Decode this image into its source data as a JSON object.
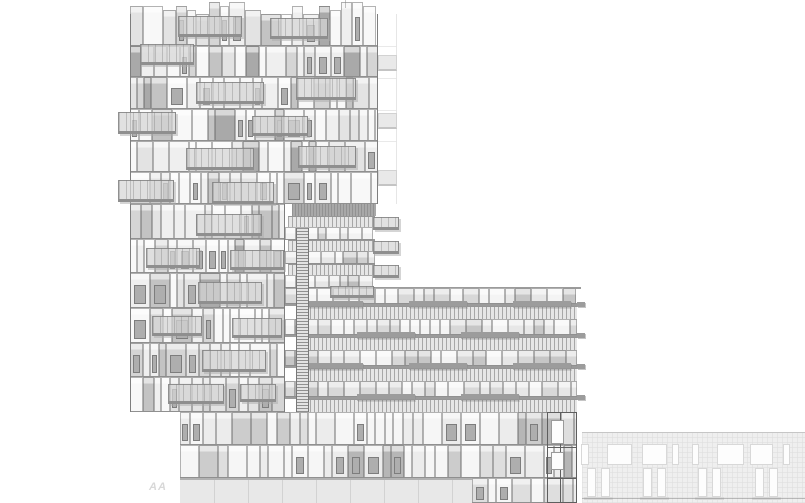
{
  "drawing": {
    "title": "building-elevation-drawing",
    "canvas": {
      "w": 805,
      "h": 503,
      "bg": "#ffffff"
    },
    "seed": 11,
    "line_color": "#8a8a8a",
    "panels": {
      "tower": {
        "widths": [
          7,
          9,
          11,
          13,
          16,
          20
        ],
        "winProb": 0.3,
        "shades": [
          [
            "#f8f8f8",
            26
          ],
          [
            "#efefef",
            22
          ],
          [
            "#e3e3e3",
            20
          ],
          [
            "#d5d5d5",
            14
          ],
          [
            "#c3c3c3",
            11
          ],
          [
            "#a9a9a9",
            7
          ]
        ]
      },
      "wing": {
        "widths": [
          8,
          11,
          14
        ],
        "winProb": 0.15,
        "shades": [
          [
            "#f3f3f3",
            35
          ],
          [
            "#e6e6e6",
            35
          ],
          [
            "#cfcfcf",
            20
          ],
          [
            "#bdbdbd",
            10
          ]
        ]
      },
      "midrise": {
        "widths": [
          10,
          13,
          16
        ],
        "winProb": 0.12,
        "shades": [
          [
            "#f4f4f4",
            30
          ],
          [
            "#e7e7e7",
            28
          ],
          [
            "#d8d8d8",
            24
          ],
          [
            "#c6c6c6",
            18
          ]
        ]
      },
      "podium": {
        "widths": [
          8,
          10,
          13,
          16,
          19
        ],
        "winProb": 0.26,
        "shades": [
          [
            "#f6f6f6",
            38
          ],
          [
            "#ececec",
            28
          ],
          [
            "#dedede",
            16
          ],
          [
            "#cccccc",
            12
          ],
          [
            "#b6b6b6",
            6
          ]
        ]
      }
    },
    "tower": {
      "upper": {
        "x": 130,
        "y": 14,
        "w": 248,
        "floors": 6,
        "floor_h": 31.67
      },
      "lower": {
        "x": 130,
        "y": 204,
        "w": 155,
        "floors": 6,
        "floor_h": 34.67
      },
      "edges": [
        {
          "x": 130,
          "y": 14,
          "h": 398
        },
        {
          "x": 377,
          "y": 14,
          "h": 190
        },
        {
          "x": 284,
          "y": 204,
          "h": 208
        }
      ],
      "roof_tick": {
        "x": 345,
        "y": 0,
        "h": 8
      }
    },
    "strip": {
      "x": 378,
      "w": 19,
      "y": 14,
      "h": 190,
      "balcony_ys": [
        55,
        113,
        170
      ],
      "balcony_h": 16,
      "line_ys": [
        46,
        78,
        110,
        141,
        173
      ]
    },
    "balconies": [
      {
        "x": 178,
        "y": 16,
        "w": 64,
        "h": 21
      },
      {
        "x": 270,
        "y": 18,
        "w": 58,
        "h": 21
      },
      {
        "x": 140,
        "y": 44,
        "w": 54,
        "h": 21
      },
      {
        "x": 196,
        "y": 82,
        "w": 68,
        "h": 22
      },
      {
        "x": 296,
        "y": 78,
        "w": 60,
        "h": 22
      },
      {
        "x": 118,
        "y": 112,
        "w": 58,
        "h": 22
      },
      {
        "x": 252,
        "y": 116,
        "w": 56,
        "h": 20
      },
      {
        "x": 186,
        "y": 148,
        "w": 68,
        "h": 22
      },
      {
        "x": 298,
        "y": 146,
        "w": 58,
        "h": 22
      },
      {
        "x": 118,
        "y": 180,
        "w": 56,
        "h": 22
      },
      {
        "x": 212,
        "y": 182,
        "w": 62,
        "h": 22
      },
      {
        "x": 196,
        "y": 214,
        "w": 66,
        "h": 22
      },
      {
        "x": 146,
        "y": 248,
        "w": 54,
        "h": 20
      },
      {
        "x": 230,
        "y": 250,
        "w": 54,
        "h": 20
      },
      {
        "x": 198,
        "y": 282,
        "w": 64,
        "h": 22
      },
      {
        "x": 152,
        "y": 316,
        "w": 50,
        "h": 20
      },
      {
        "x": 232,
        "y": 318,
        "w": 50,
        "h": 20
      },
      {
        "x": 202,
        "y": 350,
        "w": 64,
        "h": 22
      },
      {
        "x": 168,
        "y": 384,
        "w": 56,
        "h": 20
      },
      {
        "x": 240,
        "y": 384,
        "w": 36,
        "h": 18
      },
      {
        "x": 330,
        "y": 286,
        "w": 44,
        "h": 12
      }
    ],
    "wing": {
      "x": 285,
      "w": 90,
      "y": 204,
      "band": {
        "x": 292,
        "y": 204,
        "w": 84,
        "h": 12
      },
      "floors": 3,
      "floor_h": 24,
      "start_y": 216,
      "balu_h": 11,
      "win_h": 13,
      "right_balcony": {
        "dx": 88,
        "w": 26,
        "h": 13
      }
    },
    "ladder": {
      "x": 296,
      "y": 228,
      "w": 13,
      "h": 184
    },
    "midrise": {
      "x": 285,
      "w": 292,
      "y": 288,
      "floors": 4,
      "floor_h": 31,
      "win_h": 16,
      "balu_x": 302,
      "balu_h": 13,
      "step_w": 58,
      "steps": [
        [
          20,
          124,
          228
        ],
        [
          72,
          176
        ],
        [
          20,
          124,
          228
        ],
        [
          72,
          176
        ]
      ],
      "right_step_w": 8
    },
    "podium": {
      "rows": [
        {
          "x": 180,
          "y": 412,
          "w": 397,
          "h": 33
        },
        {
          "x": 180,
          "y": 445,
          "w": 397,
          "h": 33
        },
        {
          "x": 472,
          "y": 478,
          "w": 105,
          "h": 25
        }
      ]
    },
    "shaft": {
      "x": 547,
      "y": 412,
      "w": 30,
      "h": 91,
      "inner_line_x": 560,
      "line_ys": [
        447,
        478
      ],
      "windows": [
        [
          551,
          420,
          13,
          24
        ],
        [
          551,
          452,
          13,
          18
        ]
      ]
    },
    "ground": {
      "x": 180,
      "y": 478,
      "w": 292,
      "h": 25,
      "joint_gap": 34
    },
    "neighbor": {
      "x": 582,
      "y": 432,
      "w": 223,
      "h": 71,
      "upper": {
        "y": 444,
        "h": 21,
        "windows": [
          [
            581,
            8
          ],
          [
            607,
            25
          ],
          [
            642,
            25
          ],
          [
            672,
            7
          ],
          [
            692,
            7
          ],
          [
            717,
            27
          ],
          [
            750,
            23
          ],
          [
            783,
            7
          ]
        ]
      },
      "lower": {
        "y": 468,
        "h": 29,
        "pair_xs": [
          587,
          643,
          698,
          755
        ],
        "win_w": 9,
        "gap": 5
      },
      "base_line_y": 498
    },
    "mark": {
      "text": "AA",
      "x": 149,
      "y": 481
    }
  }
}
